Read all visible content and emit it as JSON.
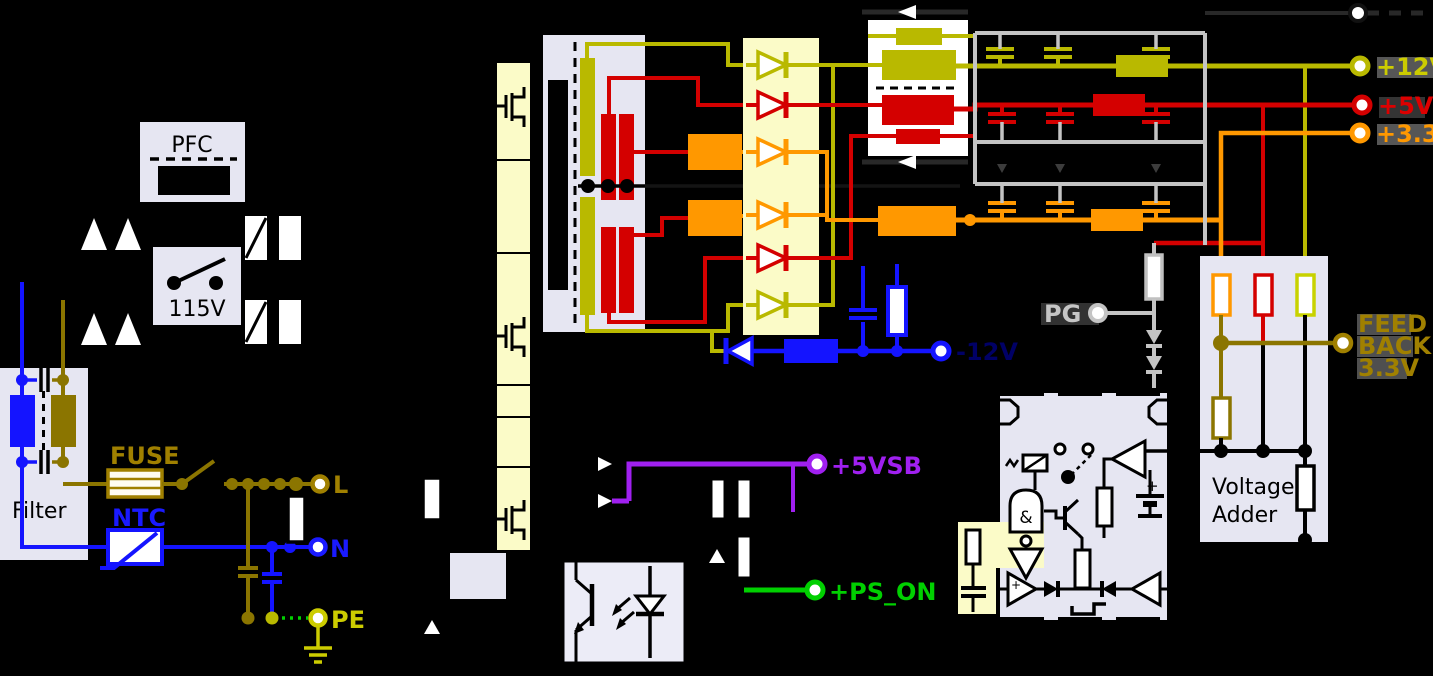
{
  "schematic": {
    "input": {
      "filter_label": "Filter",
      "fuse_label": "FUSE",
      "ntc_label": "NTC",
      "pfc_label": "PFC",
      "voltage_switch_label": "115V",
      "line_label": "L",
      "neutral_label": "N",
      "earth_label": "PE"
    },
    "outputs": {
      "p12": "+12V",
      "p5": "+5V",
      "p3v3": "+3.3V",
      "n12": "-12V",
      "standby": "+5VSB",
      "power_on": "+PS_ON",
      "power_good": "PG"
    },
    "feedback": {
      "line1": "FEED",
      "line2": "BACK",
      "line3": "3.3V"
    },
    "adder": {
      "line1": "Voltage",
      "line2": "Adder"
    },
    "ic": {
      "and_gate": "&",
      "plus": "+"
    }
  },
  "colors": {
    "rail12": "#CCCC00",
    "rail5": "#DD0000",
    "rail3v3": "#FF9800",
    "neg12": "#000066",
    "standby": "#A020F0",
    "ps_on": "#00D000",
    "line_l": "#A08000",
    "neutral": "#1A1AFF",
    "pe": "#CCCC00",
    "pg": "#C6C6C6",
    "feedback": "#A08000",
    "fuse": "#A08000",
    "ntc": "#1A1AFF",
    "wire_olive": "#8B7500",
    "wire_yellowgreen": "#B9B900",
    "wire_red": "#D40000",
    "wire_orange": "#FF9800",
    "wire_blue": "#1414FF",
    "gnd_bus": "#C4C4C4",
    "box_lavender": "#E6E6F2",
    "box_paleyellow": "#FBFBC8"
  }
}
